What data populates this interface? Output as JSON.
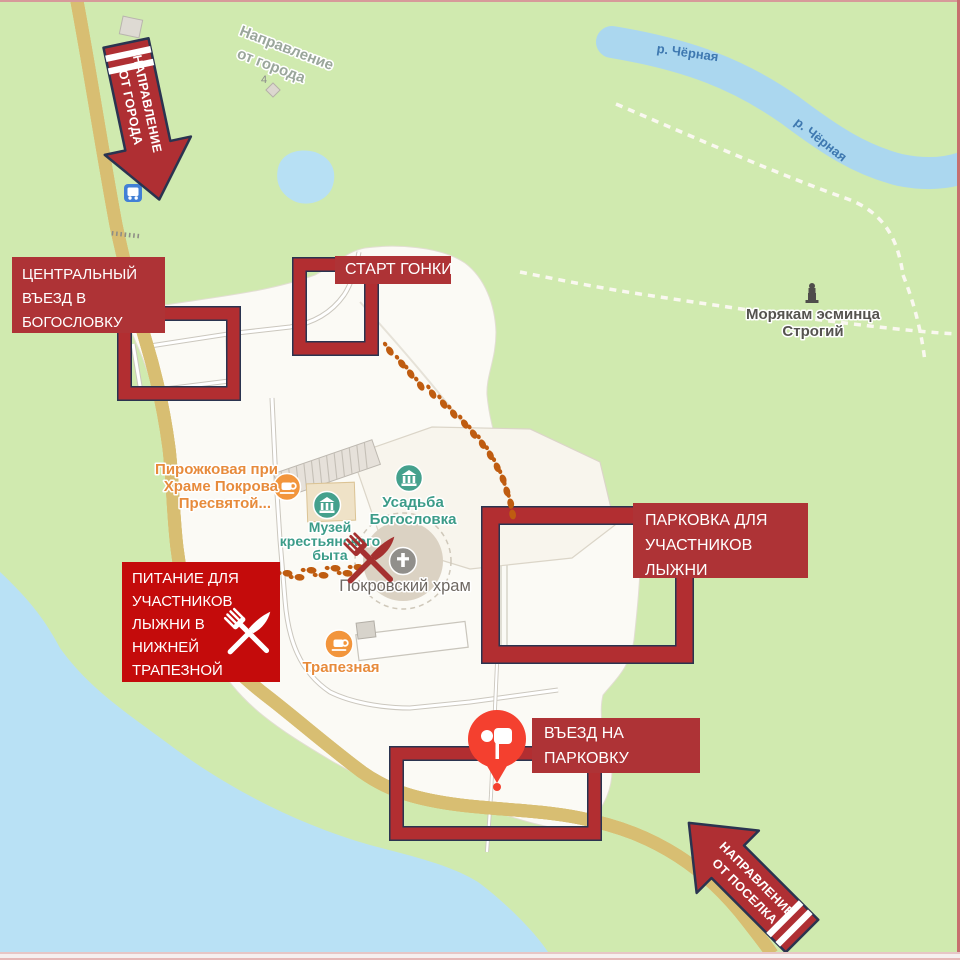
{
  "annotations": {
    "direction_from_city": {
      "lines": [
        "НАПРАВЛЕНИЕ",
        "ОТ ГОРОДА"
      ]
    },
    "direction_from_village": {
      "lines": [
        "НАПРАВЛЕНИЕ",
        "ОТ ПОСЕЛКА"
      ]
    },
    "central_entrance": {
      "lines": [
        "ЦЕНТРАЛЬНЫЙ",
        "ВЪЕЗД В",
        "БОГОСЛОВКУ"
      ]
    },
    "race_start": {
      "label": "СТАРТ ГОНКИ"
    },
    "parking": {
      "lines": [
        "ПАРКОВКА ДЛЯ",
        "УЧАСТНИКОВ",
        "ЛЫЖНИ"
      ]
    },
    "food": {
      "lines": [
        "ПИТАНИЕ ДЛЯ",
        "УЧАСТНИКОВ",
        "ЛЫЖНИ В",
        "НИЖНЕЙ",
        "ТРАПЕЗНОЙ"
      ]
    },
    "parking_entrance": {
      "lines": [
        "ВЪЕЗД НА",
        "ПАРКОВКУ"
      ]
    }
  },
  "map": {
    "ghost_direction": {
      "lines": [
        "Направление",
        "от города"
      ]
    },
    "river": {
      "label": "р. Чёрная"
    },
    "poi": {
      "pirozhkovaya": {
        "lines": [
          "Пирожковая при",
          "Храме Покрова",
          "Пресвятой..."
        ]
      },
      "museum": {
        "lines": [
          "Музей",
          "крестьянского",
          "быта"
        ]
      },
      "estate": {
        "lines": [
          "Усадьба",
          "Богословка"
        ]
      },
      "church": {
        "label": "Покровский храм"
      },
      "refectory": {
        "label": "Трапезная"
      },
      "monument": {
        "lines": [
          "Морякам эсминца",
          "Строгий"
        ]
      },
      "house_number": "4"
    }
  },
  "icons": {
    "cafe": "coffee-cup-icon",
    "museum": "classical-building-icon",
    "church": "cross-icon",
    "monument": "statue-icon",
    "bus_stop": "bus-icon",
    "pin": "map-pin-icon",
    "food": "fork-knife-crossed-icon",
    "footprints": "footprints-trail-icon"
  },
  "colors": {
    "annotation_red": "#AE3336",
    "food_red": "#C40B0B",
    "outline_navy": "#2A3450",
    "pin_red": "#F4402F",
    "footprint_orange": "#BF5C10",
    "map_green": "#D0EAAF",
    "water_blue": "#AFDAF0",
    "road_yellow": "#F6E8B0",
    "poi_teal": "#3C9C89",
    "poi_orange": "#E78B3C"
  }
}
